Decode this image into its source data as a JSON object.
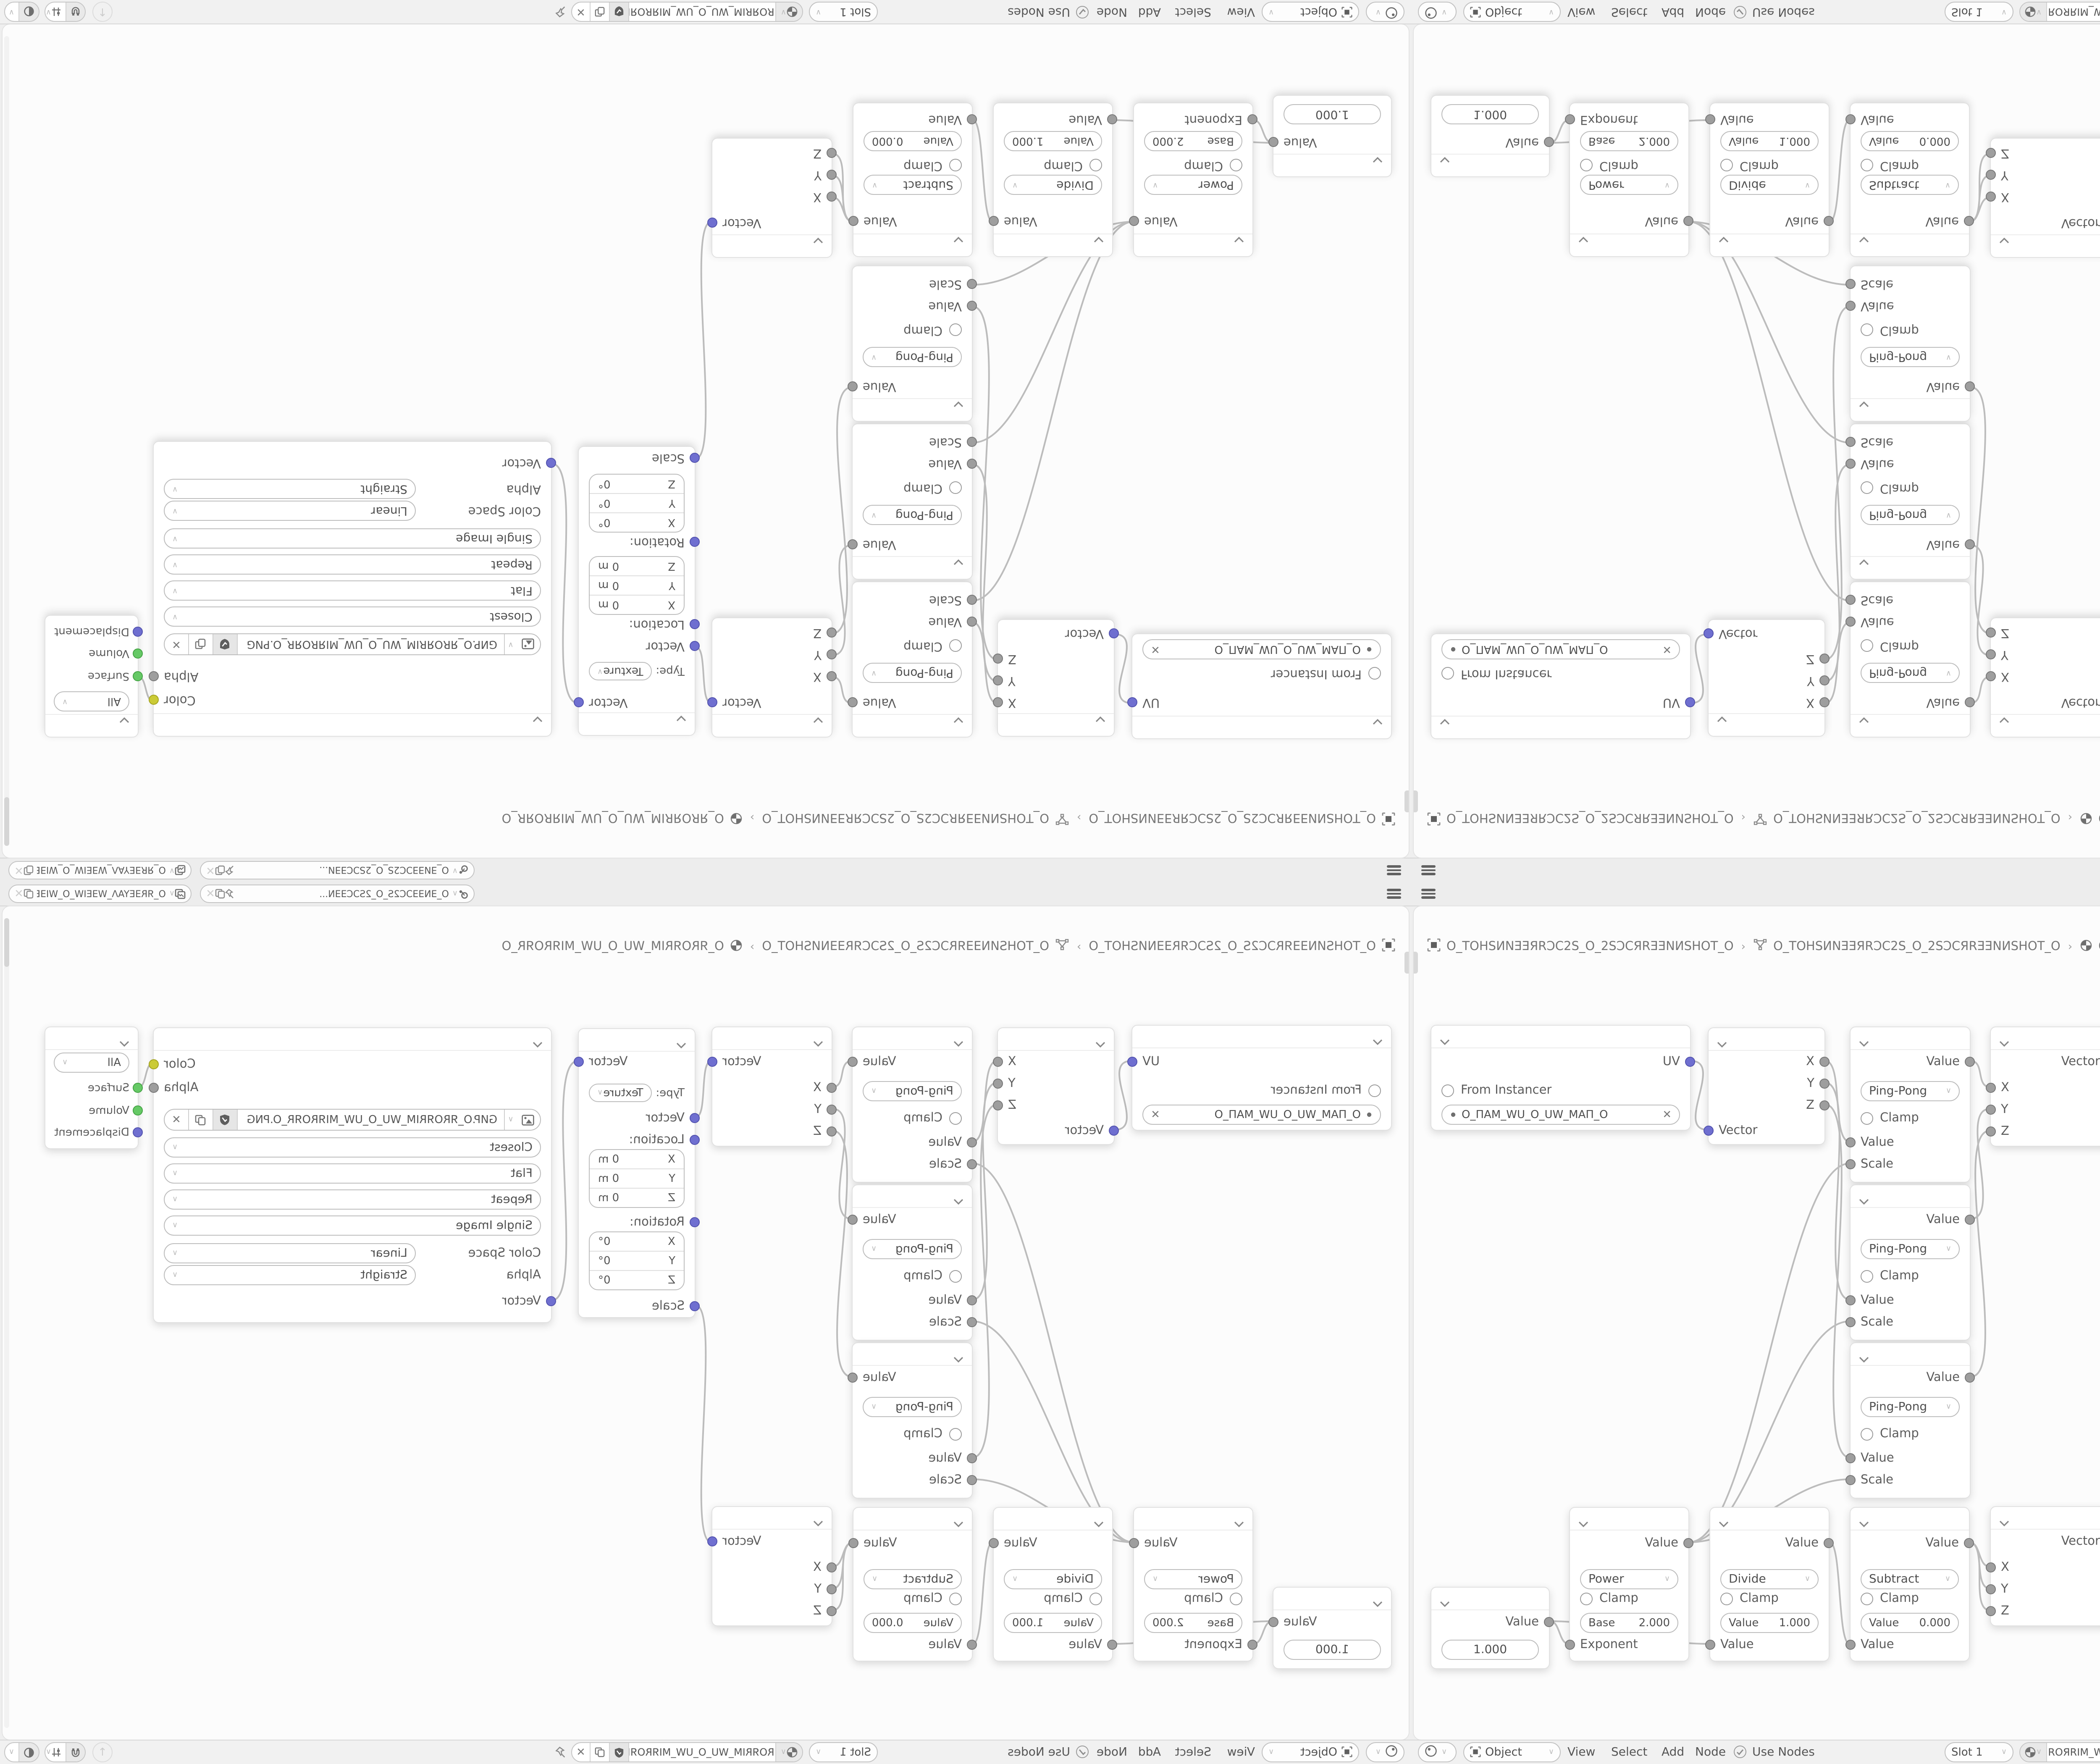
{
  "topbar": {
    "scene_name": "O_ƎNƎƎƆC2S_O_2SƆCƎƎN...",
    "view_layer_name": "O_ЯRƎEYAΛ_WƎEIW_O_WIƎEW_ΛAYƎER_O"
  },
  "breadcrumb": {
    "object_name": "O_TOHSИNƎƎЯRƆC2S_O_2SƆCЯRƎƎNИSHOT_O",
    "mesh_name": "O_TOHSИNƎƎЯRƆC2S_O_2SƆCЯRƎƎNИSHOT_O",
    "material_name": "O_ЯROЯRIM_WU_O_UW_MIЯROЯR_O",
    "separator": "›"
  },
  "nodes": {
    "uv_map": {
      "output": "UV",
      "from_instancer": "From Instancer",
      "uv_name": "O_ΠAM_WU_O_UW_MAΠ_O"
    },
    "separate_xyz": {
      "x": "X",
      "y": "Y",
      "z": "Z",
      "vector_in": "Vector"
    },
    "math_pingpong": {
      "output": "Value",
      "operation": "Ping-Pong",
      "clamp": "Clamp",
      "value_in": "Value",
      "scale_in": "Scale"
    },
    "combine_xyz": {
      "vector_out": "Vector",
      "x": "X",
      "y": "Y",
      "z": "Z"
    },
    "mapping": {
      "output": "Vector",
      "type_label": "Type:",
      "type_value": "Texture",
      "vector_in": "Vector",
      "location_label": "Location:",
      "rotation_label": "Rotation:",
      "scale_label": "Scale",
      "x": "X",
      "y": "Y",
      "z": "Z",
      "location_value": "0 m",
      "rotation_value": "0°"
    },
    "image_texture": {
      "color_out": "Color",
      "alpha_out": "Alpha",
      "filename": "GИP.O_ЯROЯRIM_WU_O_UW_MIЯROЯR_O.PNG",
      "interpolation": "Closest",
      "projection": "Flat",
      "extension": "Repeat",
      "source": "Single Image",
      "color_space_label": "Color Space",
      "color_space_value": "Linear",
      "alpha_label": "Alpha",
      "alpha_value": "Straight",
      "vector_in": "Vector"
    },
    "material_output": {
      "target": "All",
      "surface": "Surface",
      "volume": "Volume",
      "displacement": "Displacement"
    },
    "value": {
      "output": "Value",
      "value": "1.000"
    },
    "math_power": {
      "output": "Value",
      "operation": "Power",
      "clamp": "Clamp",
      "base_label": "Base",
      "base_value": "2.000",
      "exponent_in": "Exponent"
    },
    "math_divide": {
      "output": "Value",
      "operation": "Divide",
      "clamp": "Clamp",
      "value_label": "Value",
      "value_field": "1.000",
      "value_in": "Value"
    },
    "math_subtract": {
      "output": "Value",
      "operation": "Subtract",
      "clamp": "Clamp",
      "value_label": "Value",
      "value_field": "0.000",
      "value_in": "Value"
    }
  },
  "footer": {
    "mode": "Object",
    "menu_view": "View",
    "menu_select": "Select",
    "menu_add": "Add",
    "menu_node": "Node",
    "use_nodes": "Use Nodes",
    "slot": "Slot 1",
    "material_name": "O_ЯROЯRIM_WU_O_UW_MIЯROЯR_O"
  },
  "icons": {
    "close": "✕",
    "up_arrow": "↑"
  },
  "colors": {
    "socket_vector": "#6f6fd0",
    "socket_value": "#9e9e9e",
    "socket_color": "#cbcb36",
    "socket_shader": "#66c966",
    "wire": "#bcbcbc",
    "canvas_bg": "#fcfcfc",
    "node_bg": "#ffffff"
  }
}
